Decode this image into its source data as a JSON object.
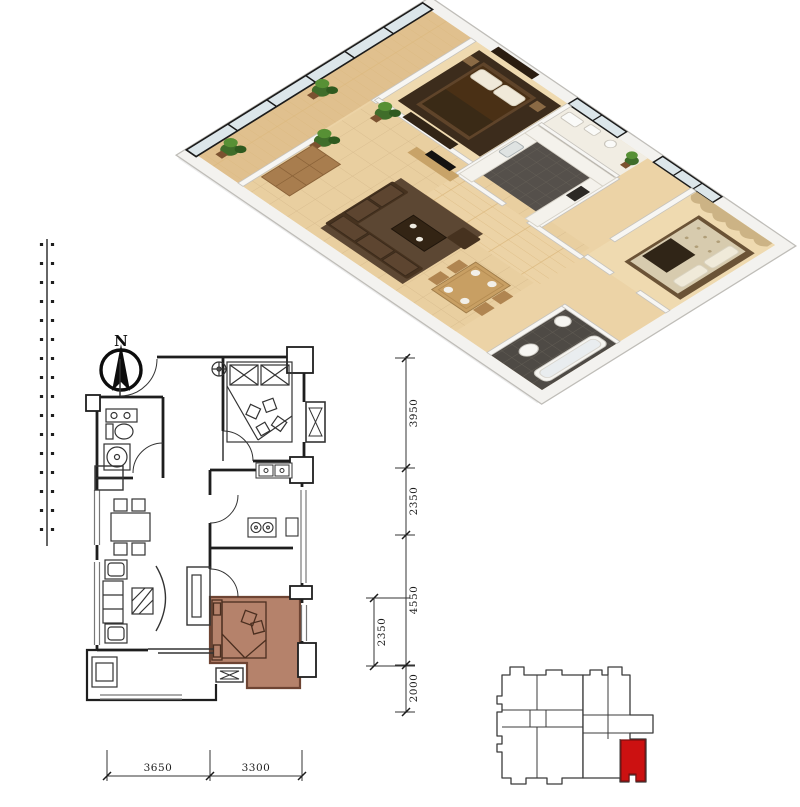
{
  "canvas": {
    "width": 800,
    "height": 807,
    "background": "#ffffff"
  },
  "compass": {
    "label": "N",
    "icon": "north-arrow-icon"
  },
  "floorplan_2d": {
    "highlighted_room": {
      "name": "secondary-bedroom",
      "fill": "#b5826b",
      "border": "#6e4433"
    },
    "dimensions": {
      "right_outer": [
        {
          "label": "3950"
        },
        {
          "label": "2350"
        },
        {
          "label": "4550"
        },
        {
          "label": "2000"
        }
      ],
      "right_inner": [
        {
          "label": "2350"
        }
      ],
      "bottom": [
        {
          "label": "3650"
        },
        {
          "label": "3300"
        }
      ]
    }
  },
  "key_plan": {
    "highlighted_unit": {
      "fill": "#cc1111",
      "border": "#7c0f0f"
    }
  }
}
